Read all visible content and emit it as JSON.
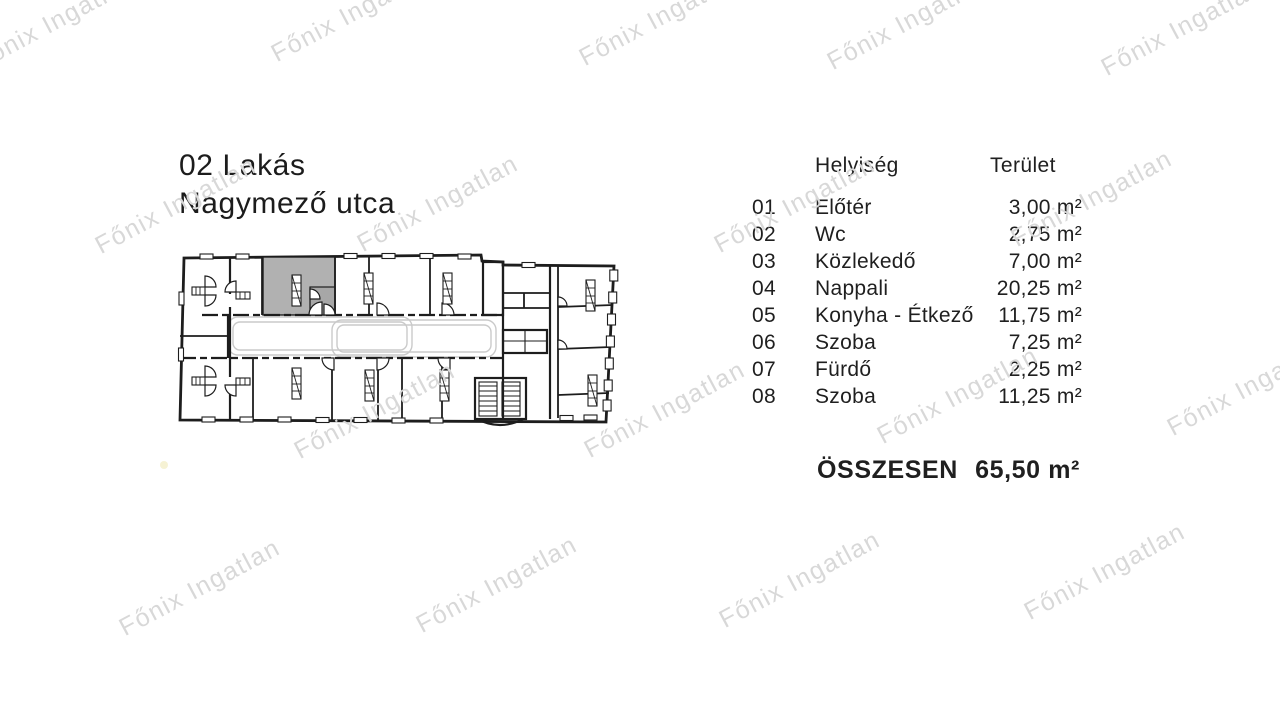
{
  "document": {
    "title_line1": "02 Lakás",
    "title_line2": "Nagymező utca"
  },
  "watermark": {
    "text": "Főnix Ingatlan",
    "color": "#d8d8d8",
    "rotation_deg": -28,
    "positions": [
      {
        "x": 55,
        "y": 22
      },
      {
        "x": 352,
        "y": 14
      },
      {
        "x": 660,
        "y": 18
      },
      {
        "x": 908,
        "y": 22
      },
      {
        "x": 1182,
        "y": 28
      },
      {
        "x": 176,
        "y": 206
      },
      {
        "x": 438,
        "y": 204
      },
      {
        "x": 795,
        "y": 205
      },
      {
        "x": 1092,
        "y": 199
      },
      {
        "x": 375,
        "y": 411
      },
      {
        "x": 665,
        "y": 410
      },
      {
        "x": 958,
        "y": 396
      },
      {
        "x": 1248,
        "y": 388
      },
      {
        "x": 200,
        "y": 588
      },
      {
        "x": 497,
        "y": 585
      },
      {
        "x": 800,
        "y": 580
      },
      {
        "x": 1105,
        "y": 572
      }
    ]
  },
  "table": {
    "header": {
      "room": "Helyiség",
      "area": "Terület"
    },
    "rows": [
      {
        "num": "01",
        "name": "Előtér",
        "area": "3,00 m²"
      },
      {
        "num": "02",
        "name": "Wc",
        "area": "2,75 m²"
      },
      {
        "num": "03",
        "name": "Közlekedő",
        "area": "7,00 m²"
      },
      {
        "num": "04",
        "name": "Nappali",
        "area": "20,25 m²"
      },
      {
        "num": "05",
        "name": "Konyha - Étkező",
        "area": "11,75 m²"
      },
      {
        "num": "06",
        "name": "Szoba",
        "area": "7,25 m²"
      },
      {
        "num": "07",
        "name": "Fürdő",
        "area": "2,25 m²"
      },
      {
        "num": "08",
        "name": "Szoba",
        "area": "11,25 m²"
      }
    ],
    "total": {
      "label": "ÖSSZESEN",
      "value": "65,50 m²"
    }
  },
  "floorplan": {
    "colors": {
      "wall": "#1d1d1d",
      "highlight": "#b1b1b1",
      "highlight_entry": "#a7a7a7",
      "corridor": "#cacaca"
    }
  },
  "page": {
    "background": "#ffffff",
    "artifact_dot_color": "#f5f1cf"
  }
}
